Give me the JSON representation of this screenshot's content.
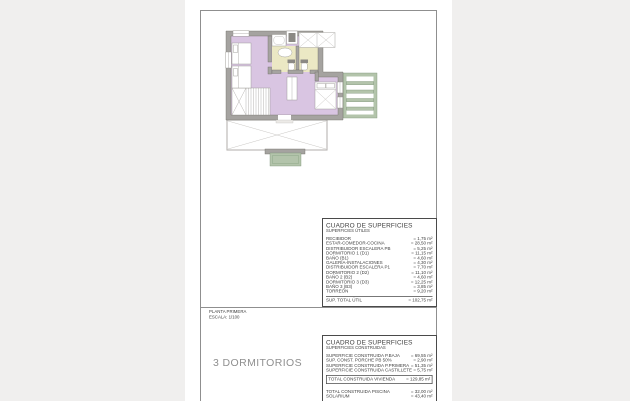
{
  "colors": {
    "bg": "#f0efee",
    "page": "#ffffff",
    "frame": "#8f8f8f",
    "table-border": "#4a4a4a",
    "text": "#3f3f3f",
    "caption": "#8f8f8f",
    "wall": "#a5a3a0",
    "room": "#d9c5e2",
    "bath": "#ebe8c4",
    "green": "#b3c4ab"
  },
  "sheet": {
    "plan_name": "PLANTA PRIMERA",
    "scale": "ESCALA: 1/100",
    "caption": "3 DORMITORIOS"
  },
  "tables": {
    "useful": {
      "title": "CUADRO DE SUPERFICIES",
      "subtitle": "SUPERFICIES ÚTILES",
      "rows": [
        {
          "label": "RECIBIDOR",
          "value": "= 1,75 m²"
        },
        {
          "label": "ESTAR-COMEDOR-COCINA",
          "value": "= 28,50 m²"
        },
        {
          "label": "DISTRIBUIDOR ESCALERA PB",
          "value": "= 5,25 m²"
        },
        {
          "label": "DORMITORIO 1 (D1)",
          "value": "= 11,15 m²"
        },
        {
          "label": "BAÑO (B1)",
          "value": "= 4,60 m²"
        },
        {
          "label": "GALERÍA-INSTALACIONES",
          "value": "= 4,30 m²"
        },
        {
          "label": "DISTRIBUIDOR ESCALERA P1",
          "value": "= 7,70 m²"
        },
        {
          "label": "DORMITORIO 2 (D2)",
          "value": "= 11,10 m²"
        },
        {
          "label": "BAÑO 2 (B2)",
          "value": "= 4,60 m²"
        },
        {
          "label": "DORMITORIO 3 (D3)",
          "value": "= 12,25 m²"
        },
        {
          "label": "BAÑO 3 (B3)",
          "value": "= 3,85 m²"
        },
        {
          "label": "TORREÓN",
          "value": "= 9,20 m²"
        }
      ],
      "total": {
        "label": "SUP. TOTAL ÚTIL",
        "value": "= 102,75 m²"
      }
    },
    "built": {
      "title": "CUADRO DE SUPERFICIES",
      "subtitle": "SUPERFICIES CONSTRUIDAS",
      "rows": [
        {
          "label": "SUPERFICIE CONSTRUIDA P.BAJA",
          "value": "= 69,55 m²"
        },
        {
          "label": "SUP. CONST. PORCHE PB 50%",
          "value": "= 2,90 m²"
        },
        {
          "label": "SUPERFICIE CONSTRUIDA P.PRIMERA",
          "value": "= 51,35 m²"
        },
        {
          "label": "SUPERFICIE CONSTRUIDA CASTILLETE",
          "value": "= 5,75 m²"
        }
      ],
      "total": {
        "label": "TOTAL CONSTRUIDA VIVIENDA",
        "value": "= 129,85 m²"
      },
      "extra_rows": [
        {
          "label": "TOTAL CONSTRUIDA PISCINA",
          "value": "= 32,00 m²"
        },
        {
          "label": "SOLARIUM",
          "value": "= 43,40 m²"
        }
      ]
    }
  }
}
